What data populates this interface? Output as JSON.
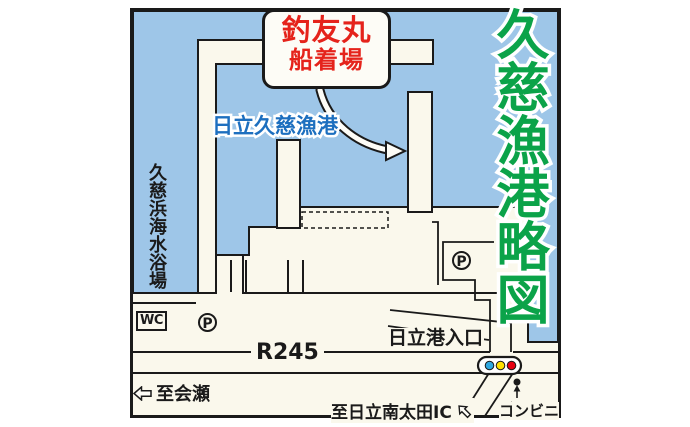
{
  "map": {
    "title": "久慈漁港略図",
    "callout": {
      "line1": "釣友丸",
      "line2": "船着場"
    },
    "labels": {
      "port_name": "日立久慈漁港",
      "beach": "久慈浜海水浴場",
      "wc": "WC",
      "parking": "P",
      "route": "R245",
      "port_entrance": "日立港入口",
      "to_aise": "至会瀬",
      "to_ic": "至日立南太田IC",
      "convenience_store": "コンビニ"
    },
    "icons": {
      "to_aise_arrow": "hollow-left-arrow",
      "to_ic_arrow": "hollow-down-left-arrow",
      "store_arrow": "up-arrow",
      "traffic_light": "blue-yellow-red-signal"
    },
    "colors": {
      "water": "#9ec6e8",
      "land": "#faf8ec",
      "outline": "#1a1a1a",
      "title_green": "#0ba349",
      "port_name_blue": "#1d6fbf",
      "callout_red": "#e5231b",
      "signal_blue": "#2ea7e0",
      "signal_yellow": "#ffe100",
      "signal_red": "#e60012"
    }
  }
}
